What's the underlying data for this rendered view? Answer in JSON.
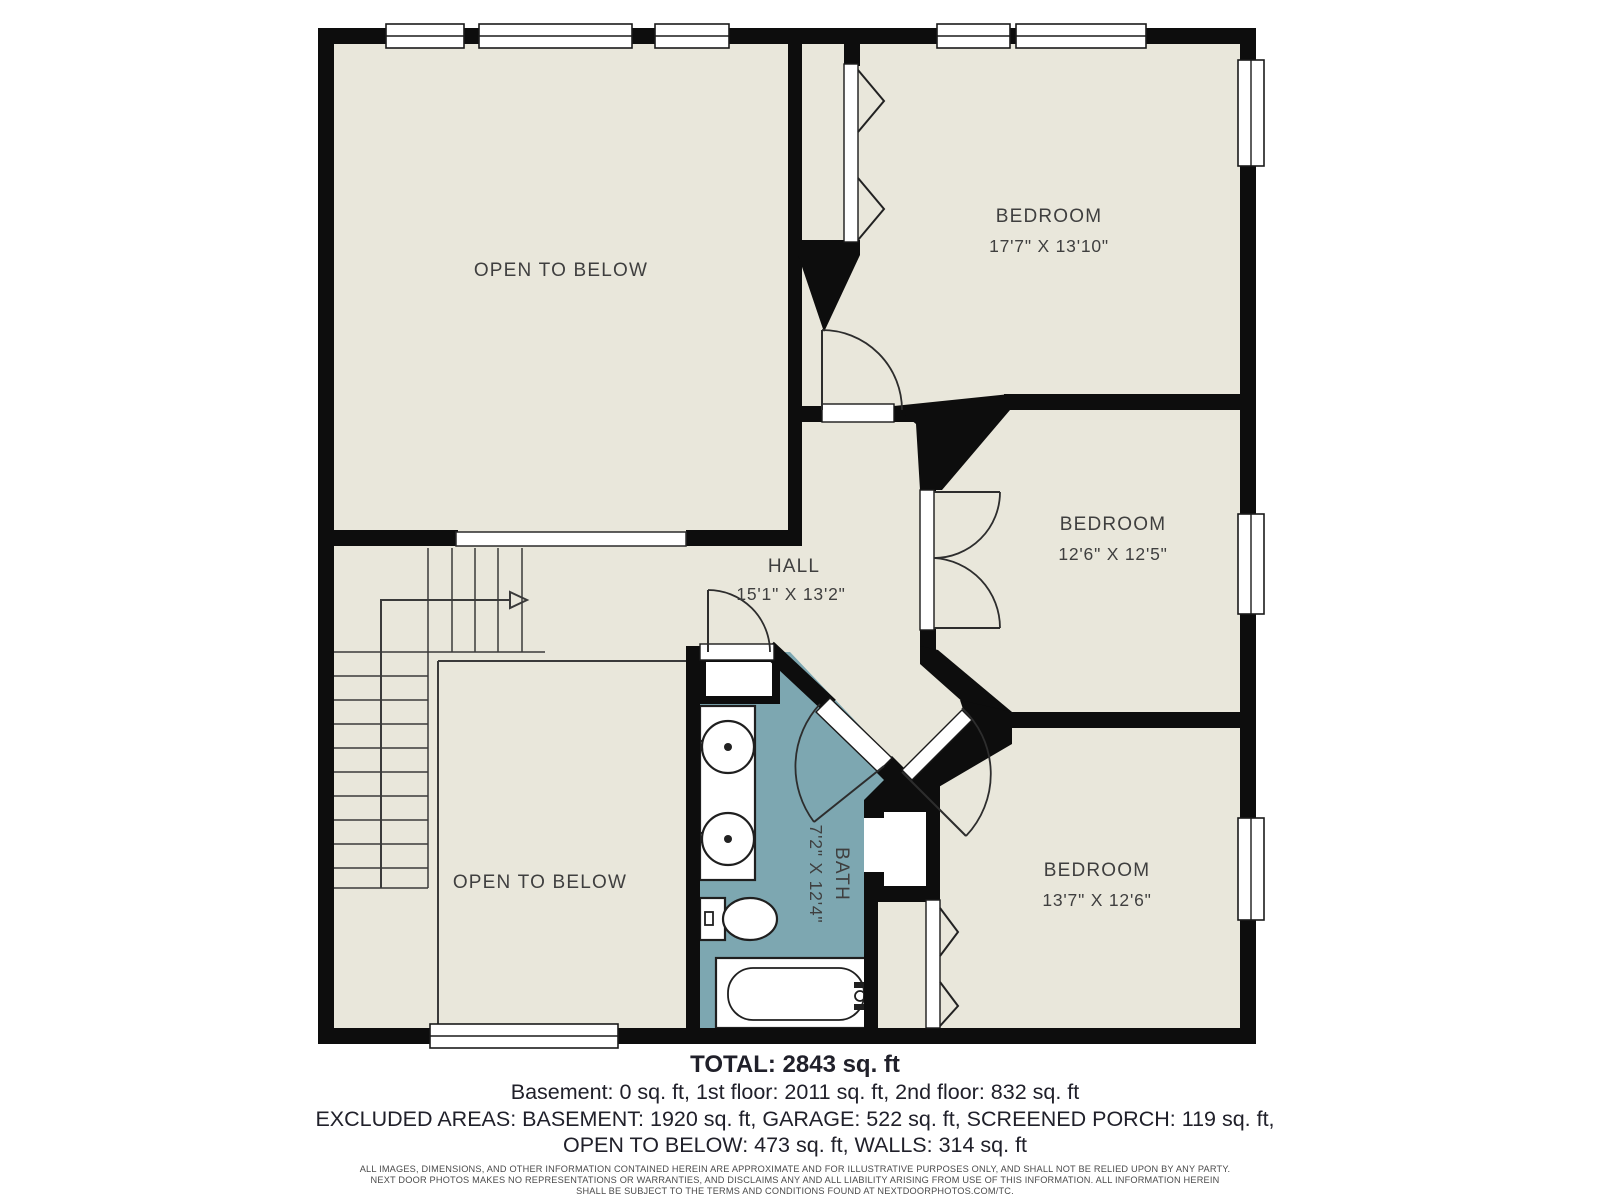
{
  "rooms": {
    "open_below_upper": {
      "name": "OPEN TO BELOW"
    },
    "bedroom_1": {
      "name": "BEDROOM",
      "dims": "17'7\" X 13'10\""
    },
    "hall": {
      "name": "HALL",
      "dims": "15'1\" X 13'2\""
    },
    "bedroom_2": {
      "name": "BEDROOM",
      "dims": "12'6\" X 12'5\""
    },
    "bath": {
      "name": "BATH",
      "dims": "7'2\" X 12'4\""
    },
    "bedroom_3": {
      "name": "BEDROOM",
      "dims": "13'7\" X 12'6\""
    },
    "open_below_lower": {
      "name": "OPEN TO BELOW"
    }
  },
  "summary": {
    "total": "TOTAL: 2843 sq. ft",
    "floors": "Basement: 0 sq. ft, 1st floor: 2011 sq. ft, 2nd floor: 832 sq. ft",
    "excluded_line_1": "EXCLUDED AREAS: BASEMENT: 1920 sq. ft, GARAGE: 522 sq. ft, SCREENED PORCH: 119 sq. ft,",
    "excluded_line_2": "OPEN TO BELOW: 473 sq. ft, WALLS: 314 sq. ft"
  },
  "disclaimer": {
    "line_1": "ALL IMAGES, DIMENSIONS, AND OTHER INFORMATION CONTAINED HEREIN ARE APPROXIMATE AND FOR ILLUSTRATIVE PURPOSES ONLY, AND SHALL NOT BE RELIED UPON BY ANY PARTY.",
    "line_2": "NEXT DOOR PHOTOS MAKES NO REPRESENTATIONS OR WARRANTIES, AND DISCLAIMS ANY AND ALL LIABILITY ARISING FROM USE OF THIS INFORMATION. ALL INFORMATION HEREIN",
    "line_3": "SHALL BE SUBJECT TO THE TERMS AND CONDITIONS FOUND AT NEXTDOORPHOTOS.COM/TC."
  },
  "colors": {
    "floor": "#e9e7db",
    "bath_floor": "#7da7b1",
    "wall": "#0d0d0d",
    "line": "#3a3a3a",
    "label": "#3f3f3f",
    "text": "#20202a",
    "fine_print": "#4a4a4a",
    "page": "#ffffff"
  }
}
